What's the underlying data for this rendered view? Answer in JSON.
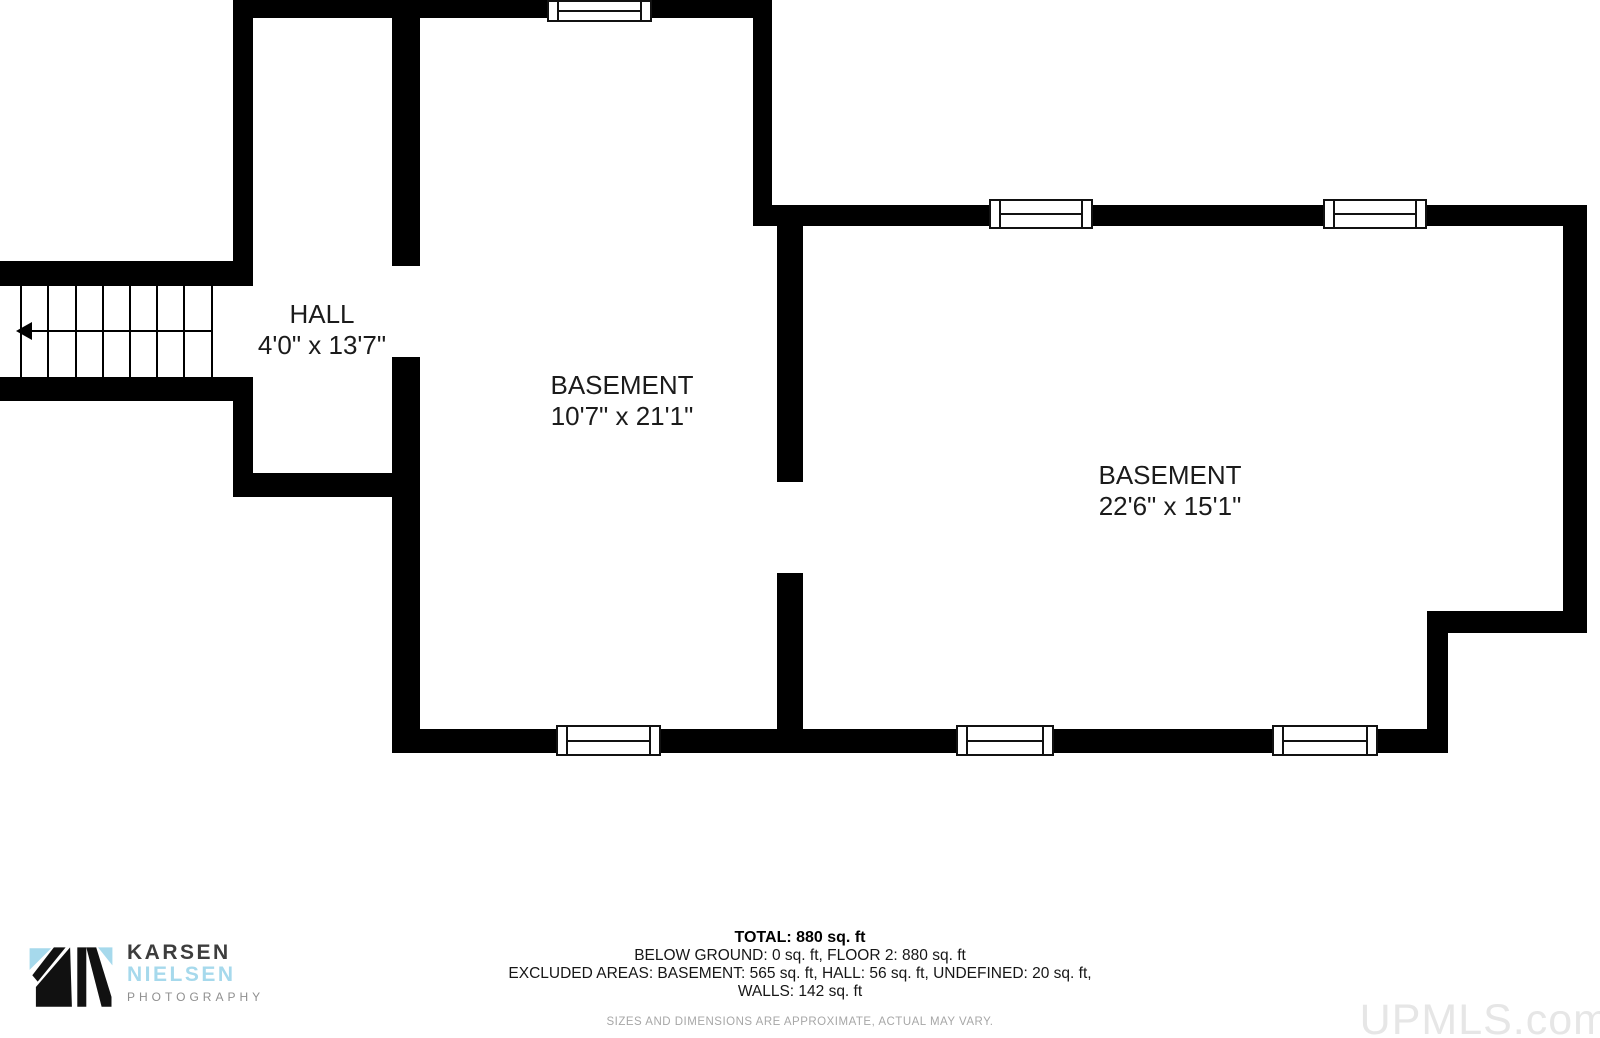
{
  "plan": {
    "rooms": [
      {
        "id": "hall",
        "name": "HALL",
        "dims": "4'0\" x 13'7\""
      },
      {
        "id": "basement-mid",
        "name": "BASEMENT",
        "dims": "10'7\" x 21'1\""
      },
      {
        "id": "basement-right",
        "name": "BASEMENT",
        "dims": "22'6\" x 15'1\""
      }
    ],
    "walls": [
      {
        "id": "top",
        "x": 233,
        "y": 0,
        "w": 539,
        "h": 18
      },
      {
        "id": "hall-left-upper",
        "x": 233,
        "y": 18,
        "w": 20,
        "h": 243
      },
      {
        "id": "stair-top-band",
        "x": 0,
        "y": 261,
        "w": 253,
        "h": 25
      },
      {
        "id": "stair-bottom-band",
        "x": 0,
        "y": 377,
        "w": 253,
        "h": 24
      },
      {
        "id": "hall-left-lower",
        "x": 233,
        "y": 401,
        "w": 20,
        "h": 72
      },
      {
        "id": "hall-bottom",
        "x": 233,
        "y": 473,
        "w": 187,
        "h": 24
      },
      {
        "id": "hall-right-upper",
        "x": 392,
        "y": 18,
        "w": 28,
        "h": 248
      },
      {
        "id": "hall-right-lower",
        "x": 392,
        "y": 357,
        "w": 28,
        "h": 372
      },
      {
        "id": "mid-right-upper",
        "x": 753,
        "y": 18,
        "w": 19,
        "h": 202
      },
      {
        "id": "rb-top",
        "x": 753,
        "y": 205,
        "w": 830,
        "h": 21
      },
      {
        "id": "divider-upper",
        "x": 777,
        "y": 220,
        "w": 26,
        "h": 262
      },
      {
        "id": "divider-lower",
        "x": 777,
        "y": 573,
        "w": 26,
        "h": 156
      },
      {
        "id": "rb-right",
        "x": 1563,
        "y": 205,
        "w": 24,
        "h": 428
      },
      {
        "id": "notch-horizontal",
        "x": 1427,
        "y": 611,
        "w": 160,
        "h": 22
      },
      {
        "id": "notch-vertical",
        "x": 1427,
        "y": 633,
        "w": 21,
        "h": 96
      },
      {
        "id": "bottom",
        "x": 392,
        "y": 729,
        "w": 1056,
        "h": 24
      }
    ],
    "windows": [
      {
        "id": "top-mid",
        "x": 547,
        "y": 0,
        "w": 105,
        "h": 22
      },
      {
        "id": "rb-top-1",
        "x": 989,
        "y": 199,
        "w": 104,
        "h": 30
      },
      {
        "id": "rb-top-2",
        "x": 1323,
        "y": 199,
        "w": 104,
        "h": 30
      },
      {
        "id": "bottom-mid",
        "x": 556,
        "y": 725,
        "w": 105,
        "h": 31
      },
      {
        "id": "bottom-rb-1",
        "x": 956,
        "y": 725,
        "w": 98,
        "h": 31
      },
      {
        "id": "bottom-rb-2",
        "x": 1272,
        "y": 725,
        "w": 106,
        "h": 31
      }
    ],
    "stairs": {
      "x": 14,
      "y": 286,
      "w": 224,
      "h": 91,
      "treads": [
        6,
        33,
        61,
        88,
        115,
        142,
        169,
        197
      ],
      "arrow": {
        "line_x1": 14,
        "line_x2": 198,
        "y": 44,
        "head_tip_x": 2
      }
    }
  },
  "footer": {
    "total": "TOTAL: 880 sq. ft",
    "below_ground": "BELOW GROUND: 0 sq. ft, FLOOR 2: 880 sq. ft",
    "excluded": "EXCLUDED AREAS: BASEMENT: 565 sq. ft, HALL: 56 sq. ft, UNDEFINED: 20 sq. ft,",
    "walls_line": "WALLS: 142 sq. ft",
    "disclaimer": "SIZES AND DIMENSIONS ARE APPROXIMATE, ACTUAL MAY VARY.",
    "watermark": "UPMLS.com",
    "logo": {
      "name_top": "KARSEN",
      "name_bottom": "NIELSEN",
      "tagline": "PHOTOGRAPHY"
    }
  },
  "colors": {
    "wall": "#000000",
    "logo_blue": "#a6d9ec",
    "logo_dark": "#3d3d3d",
    "logo_gray": "#8f8f8f",
    "text": "#1b1b1b",
    "disclaimer_gray": "#a7a7a7",
    "watermark_gray": "#e6e6e6"
  }
}
